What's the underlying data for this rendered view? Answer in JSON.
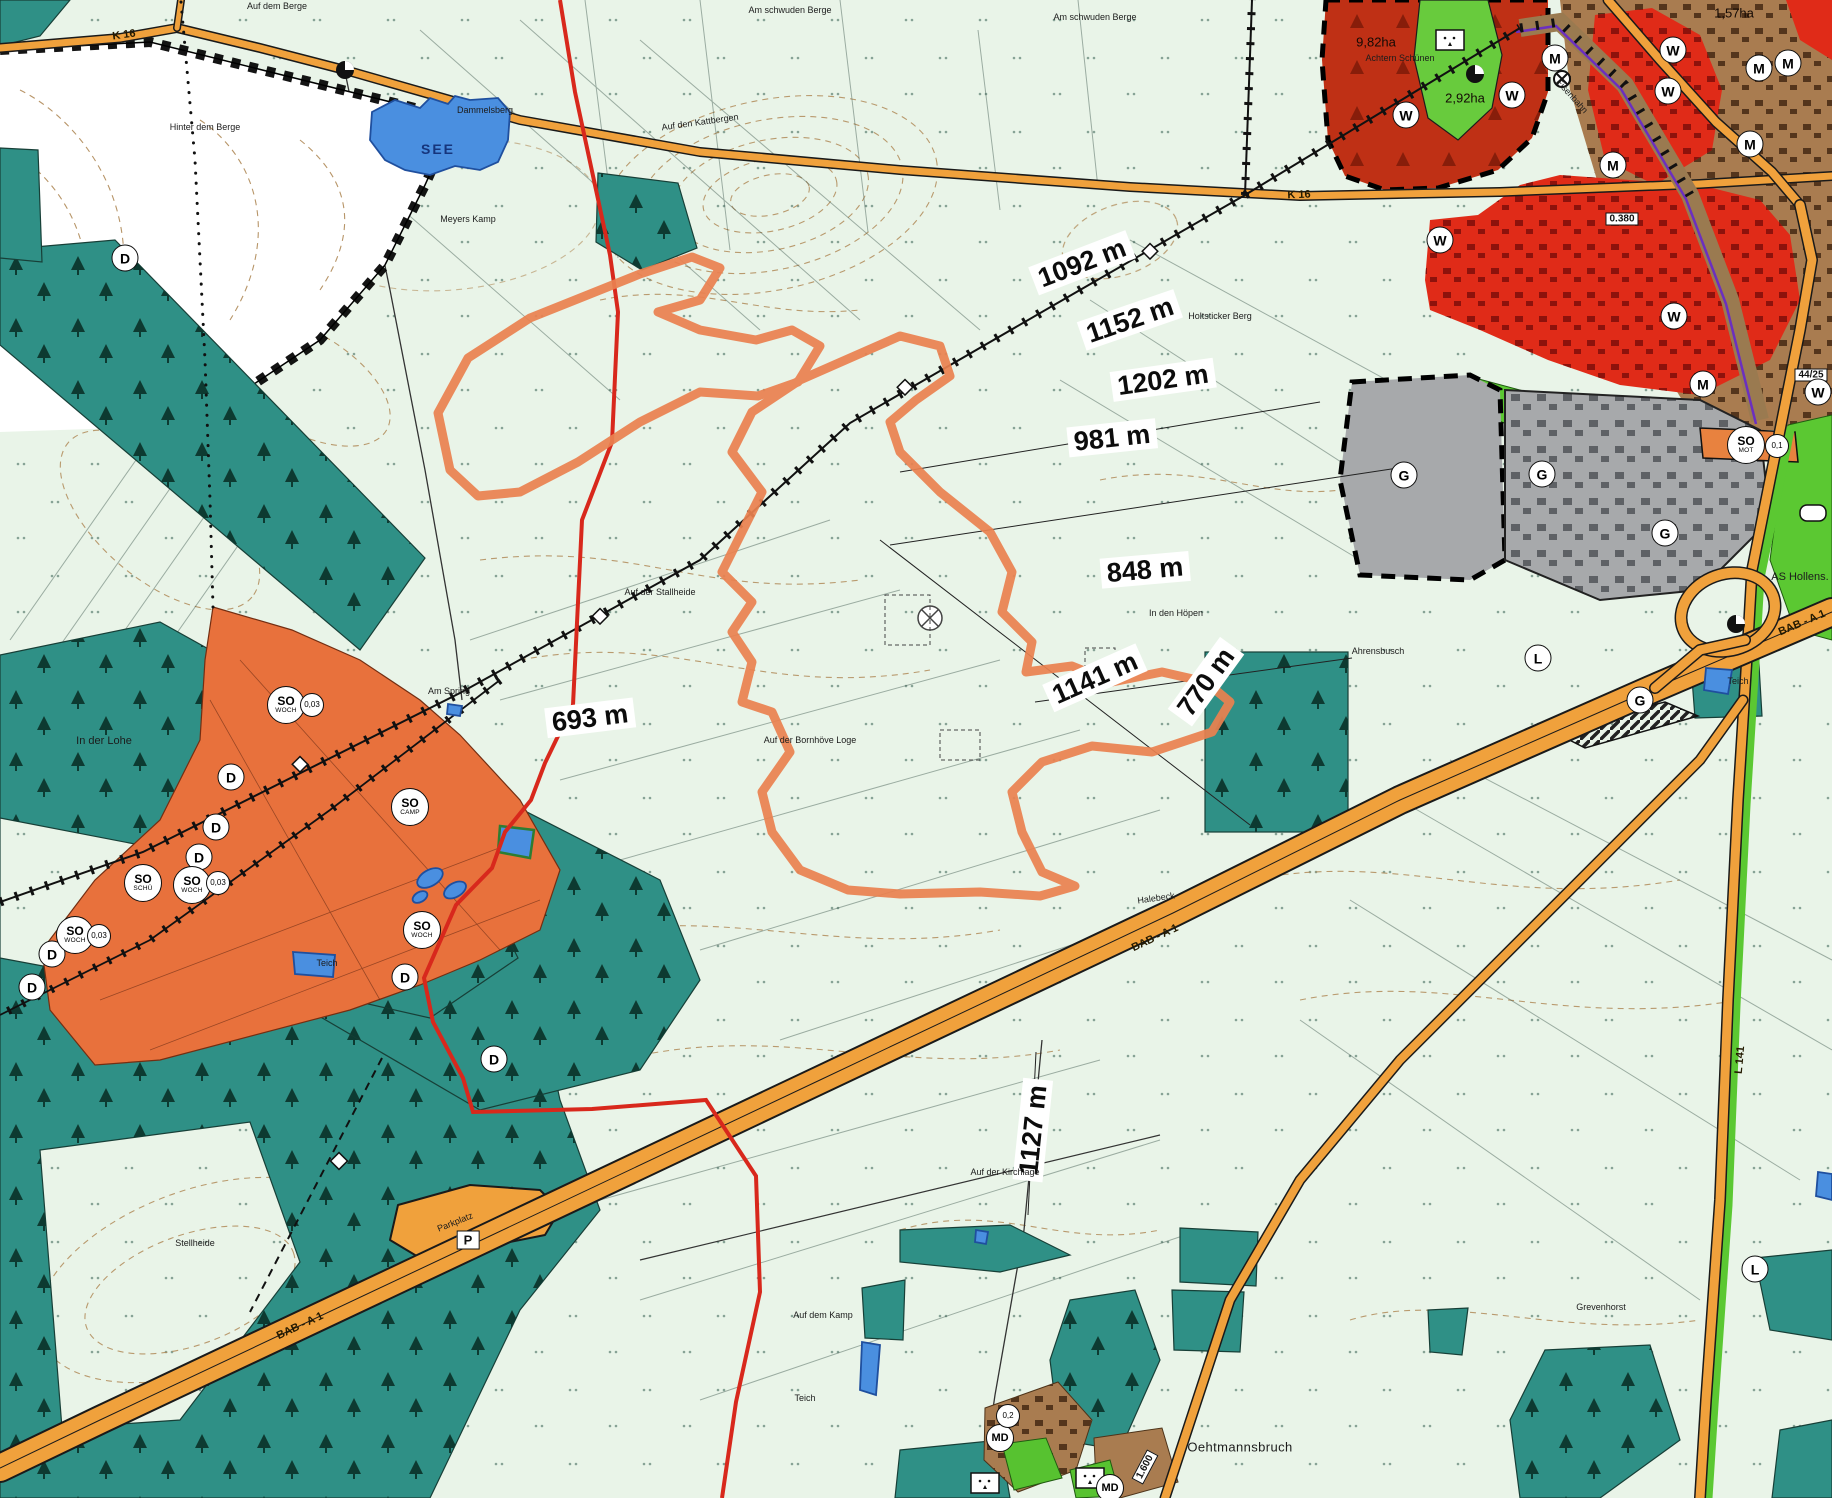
{
  "map": {
    "colors": {
      "background": "#e9f4e8",
      "forest": "#2f9086",
      "special_so_zone": "#e8713c",
      "dark_red_zone": "#bf3015",
      "residential_red": "#e02b18",
      "mixed_brown": "#a97c50",
      "industrial_gray": "#a7a9ab",
      "green_space": "#5bc832",
      "inner_green": "#68cb3d",
      "road_orange": "#f0a13c",
      "water_blue": "#4a8fe0",
      "boundary_red": "#d8281c",
      "project_outline": "#ea8150",
      "contour_brown": "#b08a58",
      "railway_black": "#111111"
    },
    "lake": {
      "label": "SEE"
    },
    "measurements": [
      {
        "text": "1092 m",
        "x": 1082,
        "y": 263,
        "rot": -21
      },
      {
        "text": "1152 m",
        "x": 1130,
        "y": 320,
        "rot": -19
      },
      {
        "text": "1202 m",
        "x": 1163,
        "y": 380,
        "rot": -8
      },
      {
        "text": "981 m",
        "x": 1112,
        "y": 438,
        "rot": -6
      },
      {
        "text": "848 m",
        "x": 1145,
        "y": 570,
        "rot": -5
      },
      {
        "text": "1141 m",
        "x": 1095,
        "y": 678,
        "rot": -24
      },
      {
        "text": "770 m",
        "x": 1206,
        "y": 682,
        "rot": -54
      },
      {
        "text": "693 m",
        "x": 590,
        "y": 718,
        "rot": -7
      },
      {
        "text": "1127 m",
        "x": 1033,
        "y": 1130,
        "rot": -84
      }
    ],
    "place_labels": [
      {
        "text": "Auf dem Berge",
        "x": 277,
        "y": 6,
        "rot": 0,
        "cls": "t"
      },
      {
        "text": "Am schwuden Berge",
        "x": 790,
        "y": 10,
        "rot": 0,
        "cls": "t"
      },
      {
        "text": "Am schwuden Berge",
        "x": 1095,
        "y": 17,
        "rot": 0,
        "cls": "t"
      },
      {
        "text": "Auf den Kattbergen",
        "x": 700,
        "y": 122,
        "rot": -8,
        "cls": "t"
      },
      {
        "text": "Hinter dem Berge",
        "x": 205,
        "y": 127,
        "rot": 0,
        "cls": "t"
      },
      {
        "text": "Dammelsberg",
        "x": 485,
        "y": 110,
        "rot": 0,
        "cls": "t"
      },
      {
        "text": "Meyers Kamp",
        "x": 468,
        "y": 219,
        "rot": 0,
        "cls": "t"
      },
      {
        "text": "Holtsticker Berg",
        "x": 1220,
        "y": 316,
        "rot": 0,
        "cls": "t"
      },
      {
        "text": "Achtern Schünen",
        "x": 1400,
        "y": 58,
        "rot": 0,
        "cls": "t"
      },
      {
        "text": "In den Höpen",
        "x": 1176,
        "y": 613,
        "rot": 0,
        "cls": "t"
      },
      {
        "text": "Ahrensbusch",
        "x": 1378,
        "y": 651,
        "rot": 0,
        "cls": "t"
      },
      {
        "text": "In der Lohe",
        "x": 104,
        "y": 741,
        "rot": 0,
        "cls": "s"
      },
      {
        "text": "Am Spring",
        "x": 449,
        "y": 691,
        "rot": 0,
        "cls": "t"
      },
      {
        "text": "Auf der Stallheide",
        "x": 660,
        "y": 592,
        "rot": 0,
        "cls": "t"
      },
      {
        "text": "Auf der Bornhöve Loge",
        "x": 810,
        "y": 740,
        "rot": 0,
        "cls": "t"
      },
      {
        "text": "Halebeck",
        "x": 1156,
        "y": 898,
        "rot": -8,
        "cls": "t"
      },
      {
        "text": "Auf der Kirchlage",
        "x": 1005,
        "y": 1172,
        "rot": 0,
        "cls": "t"
      },
      {
        "text": "Auf dem Kamp",
        "x": 823,
        "y": 1315,
        "rot": 0,
        "cls": "t"
      },
      {
        "text": "Teich",
        "x": 327,
        "y": 963,
        "rot": 0,
        "cls": "t"
      },
      {
        "text": "Teich",
        "x": 805,
        "y": 1398,
        "rot": 0,
        "cls": "t"
      },
      {
        "text": "Teich",
        "x": 1738,
        "y": 681,
        "rot": 0,
        "cls": "t"
      },
      {
        "text": "Stellheide",
        "x": 195,
        "y": 1243,
        "rot": 0,
        "cls": "t"
      },
      {
        "text": "Oehtmannsbruch",
        "x": 1240,
        "y": 1447,
        "rot": 0,
        "cls": "m"
      },
      {
        "text": "Grevenhorst",
        "x": 1601,
        "y": 1307,
        "rot": 0,
        "cls": "t"
      },
      {
        "text": "Parkplatz",
        "x": 455,
        "y": 1222,
        "rot": -22,
        "cls": "t"
      },
      {
        "text": "AS Hollens.",
        "x": 1800,
        "y": 577,
        "rot": 0,
        "cls": "s"
      },
      {
        "text": "Eisenbahn",
        "x": 1572,
        "y": 96,
        "rot": 48,
        "cls": "t"
      }
    ],
    "road_labels": [
      {
        "text": "K 16",
        "x": 124,
        "y": 35,
        "rot": -8
      },
      {
        "text": "K 16",
        "x": 1299,
        "y": 195,
        "rot": -2
      },
      {
        "text": "BAB - A 1",
        "x": 1802,
        "y": 623,
        "rot": -23
      },
      {
        "text": "BAB - A 1",
        "x": 1155,
        "y": 938,
        "rot": -25
      },
      {
        "text": "BAB - A 1",
        "x": 300,
        "y": 1326,
        "rot": -25
      },
      {
        "text": "L 141",
        "x": 1740,
        "y": 1060,
        "rot": -85
      }
    ],
    "area_labels": [
      {
        "text": "9,82ha",
        "x": 1376,
        "y": 42
      },
      {
        "text": "2,92ha",
        "x": 1465,
        "y": 98
      },
      {
        "text": "1,57ha",
        "x": 1734,
        "y": 13
      }
    ],
    "boxes": [
      {
        "text": "0.380",
        "x": 1622,
        "y": 219,
        "rot": 0
      },
      {
        "text": "44/25",
        "x": 1811,
        "y": 375,
        "rot": 0
      },
      {
        "text": "1.600",
        "x": 1145,
        "y": 1467,
        "rot": -62
      },
      {
        "text": "P",
        "x": 468,
        "y": 1240,
        "rot": 0,
        "cls": "pbox"
      }
    ],
    "badges": [
      {
        "type": "l",
        "label": "W",
        "x": 1406,
        "y": 115
      },
      {
        "type": "l",
        "label": "W",
        "x": 1512,
        "y": 95
      },
      {
        "type": "l",
        "label": "W",
        "x": 1673,
        "y": 50
      },
      {
        "type": "l",
        "label": "W",
        "x": 1668,
        "y": 91
      },
      {
        "type": "l",
        "label": "W",
        "x": 1440,
        "y": 240
      },
      {
        "type": "l",
        "label": "W",
        "x": 1674,
        "y": 316
      },
      {
        "type": "l",
        "label": "W",
        "x": 1818,
        "y": 392
      },
      {
        "type": "l",
        "label": "M",
        "x": 1555,
        "y": 58
      },
      {
        "type": "l",
        "label": "M",
        "x": 1759,
        "y": 68
      },
      {
        "type": "l",
        "label": "M",
        "x": 1788,
        "y": 63
      },
      {
        "type": "l",
        "label": "M",
        "x": 1750,
        "y": 144
      },
      {
        "type": "l",
        "label": "M",
        "x": 1613,
        "y": 165
      },
      {
        "type": "l",
        "label": "M",
        "x": 1703,
        "y": 384
      },
      {
        "type": "l",
        "label": "G",
        "x": 1404,
        "y": 475
      },
      {
        "type": "l",
        "label": "G",
        "x": 1542,
        "y": 474
      },
      {
        "type": "l",
        "label": "G",
        "x": 1665,
        "y": 533
      },
      {
        "type": "l",
        "label": "G",
        "x": 1640,
        "y": 700
      },
      {
        "type": "l",
        "label": "D",
        "x": 125,
        "y": 258
      },
      {
        "type": "l",
        "label": "D",
        "x": 231,
        "y": 777
      },
      {
        "type": "l",
        "label": "D",
        "x": 216,
        "y": 827
      },
      {
        "type": "l",
        "label": "D",
        "x": 199,
        "y": 857
      },
      {
        "type": "l",
        "label": "D",
        "x": 52,
        "y": 954
      },
      {
        "type": "l",
        "label": "D",
        "x": 32,
        "y": 987
      },
      {
        "type": "l",
        "label": "D",
        "x": 405,
        "y": 977
      },
      {
        "type": "l",
        "label": "D",
        "x": 494,
        "y": 1059
      },
      {
        "type": "l",
        "label": "L",
        "x": 1538,
        "y": 658
      },
      {
        "type": "l",
        "label": "L",
        "x": 1755,
        "y": 1269
      },
      {
        "type": "md",
        "label": "MD",
        "x": 1000,
        "y": 1438
      },
      {
        "type": "md",
        "label": "MD",
        "x": 1110,
        "y": 1488
      },
      {
        "type": "so",
        "label": "SO",
        "sub": "WOCH",
        "x": 286,
        "y": 705
      },
      {
        "type": "so",
        "label": "SO",
        "sub": "WOCH",
        "x": 192,
        "y": 885
      },
      {
        "type": "so",
        "label": "SO",
        "sub": "WOCH",
        "x": 75,
        "y": 935
      },
      {
        "type": "so",
        "label": "SO",
        "sub": "WOCH",
        "x": 422,
        "y": 930
      },
      {
        "type": "so",
        "label": "SO",
        "sub": "CAMP",
        "x": 410,
        "y": 807
      },
      {
        "type": "so",
        "label": "SO",
        "sub": "SCHÜ",
        "x": 143,
        "y": 883
      },
      {
        "type": "so",
        "label": "SO",
        "sub": "MOT",
        "x": 1746,
        "y": 445
      },
      {
        "type": "num",
        "label": "0,03",
        "x": 312,
        "y": 705
      },
      {
        "type": "num",
        "label": "0,03",
        "x": 218,
        "y": 883
      },
      {
        "type": "num",
        "label": "0,03",
        "x": 99,
        "y": 936
      },
      {
        "type": "num",
        "label": "0,1",
        "x": 1777,
        "y": 446
      },
      {
        "type": "num",
        "label": "0,2",
        "x": 1008,
        "y": 1416
      }
    ]
  }
}
